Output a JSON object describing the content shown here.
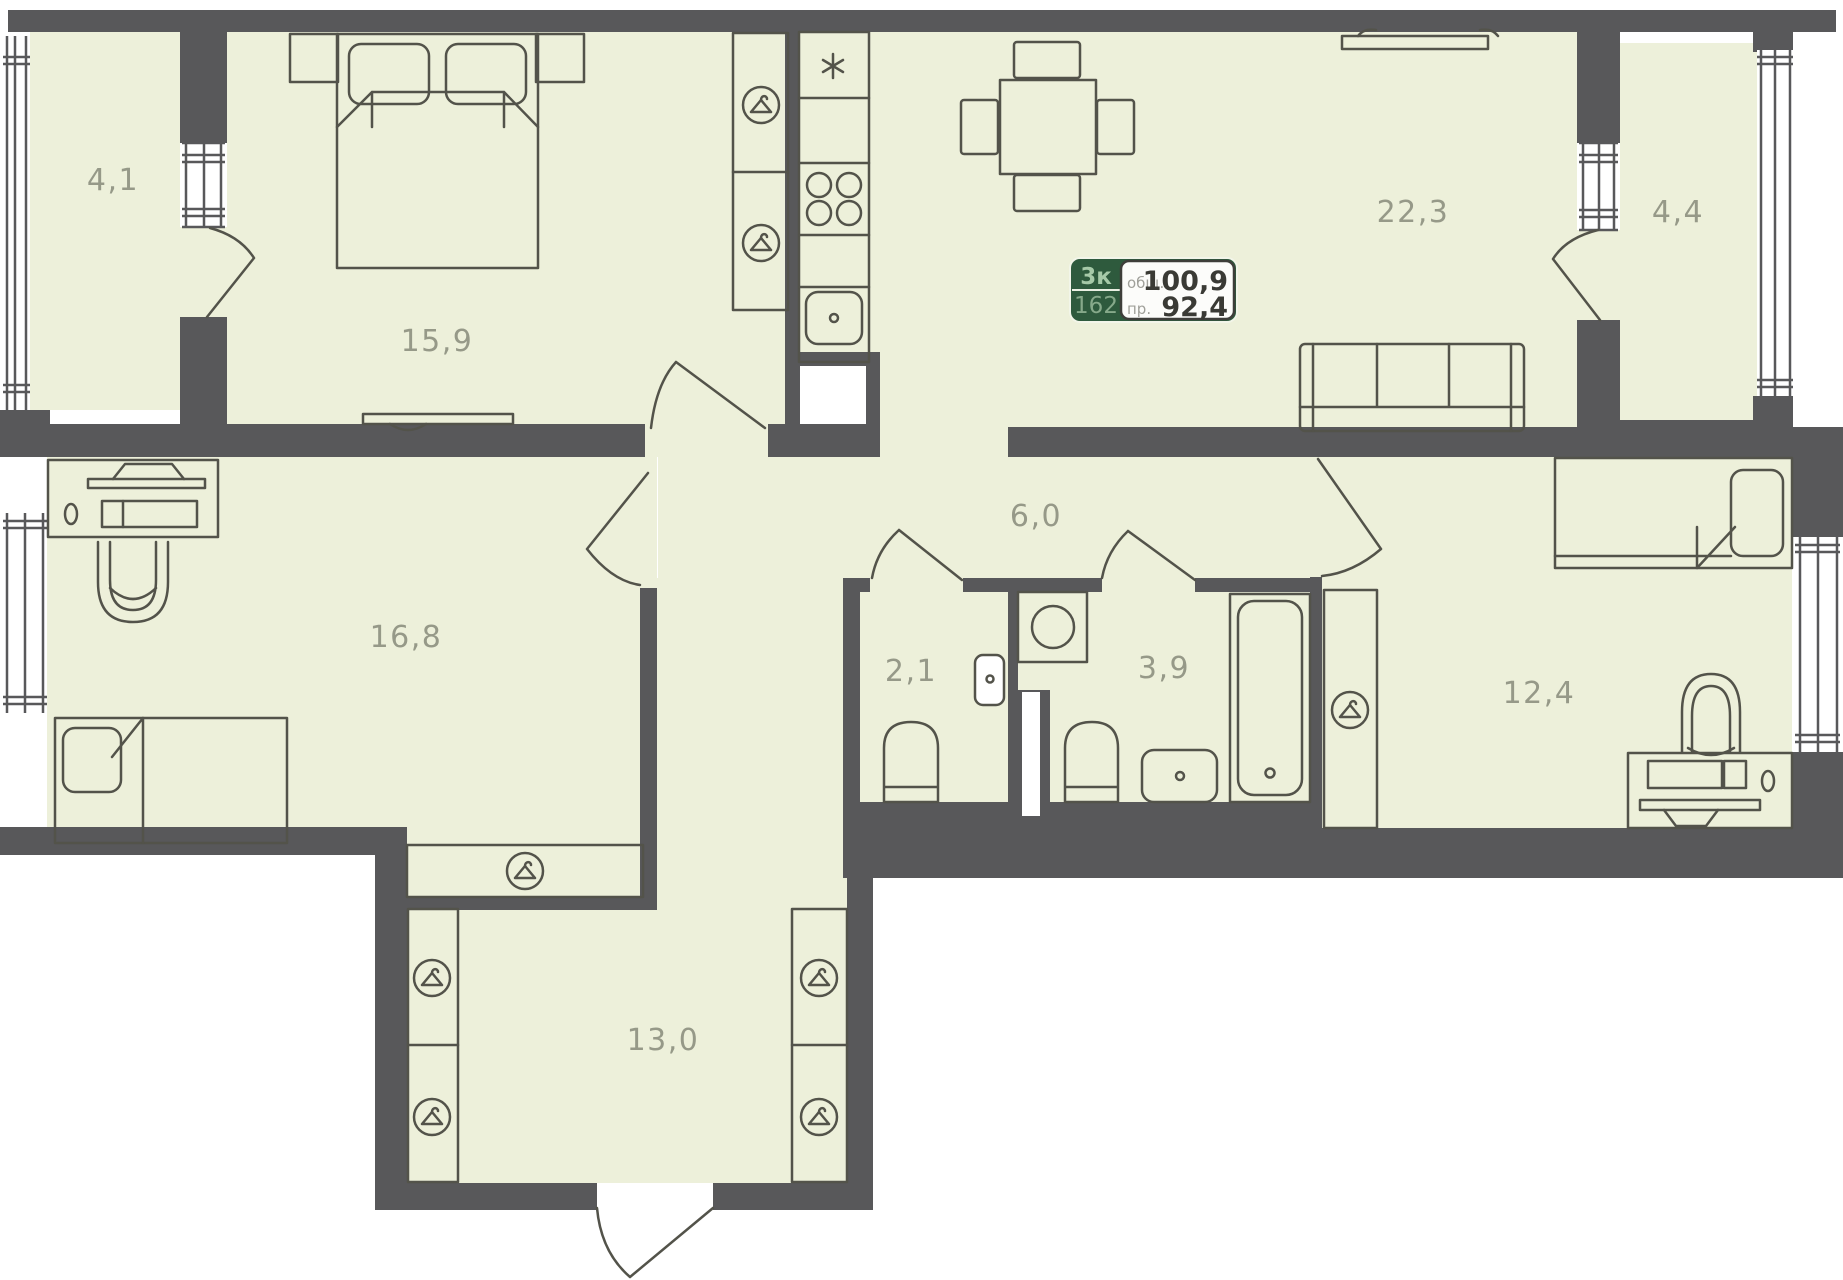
{
  "plan_title": "apartment-floor-plan",
  "badge": {
    "rooms_count": "3к",
    "unit_number": "162",
    "total_label": "общ.",
    "total_area": "100,9",
    "living_label": "пр.",
    "living_area": "92,4"
  },
  "rooms": [
    {
      "id": "balcony-left",
      "area": "4,1"
    },
    {
      "id": "bedroom-main",
      "area": "15,9"
    },
    {
      "id": "kitchen-living",
      "area": "22,3"
    },
    {
      "id": "balcony-right",
      "area": "4,4"
    },
    {
      "id": "office-bedroom",
      "area": "16,8"
    },
    {
      "id": "hallway",
      "area": "6,0"
    },
    {
      "id": "wc",
      "area": "2,1"
    },
    {
      "id": "bathroom",
      "area": "3,9"
    },
    {
      "id": "bedroom-second",
      "area": "12,4"
    },
    {
      "id": "corridor",
      "area": "13,0"
    }
  ],
  "colors": {
    "wall": "#58585a",
    "floor": "#edf0da",
    "line": "#53534a",
    "label": "#8d9080",
    "badge_green": "#2e5a3d",
    "badge_panel": "#fcfcfa",
    "badge_number": "#3a3a35",
    "badge_label": "#a0a09a"
  }
}
